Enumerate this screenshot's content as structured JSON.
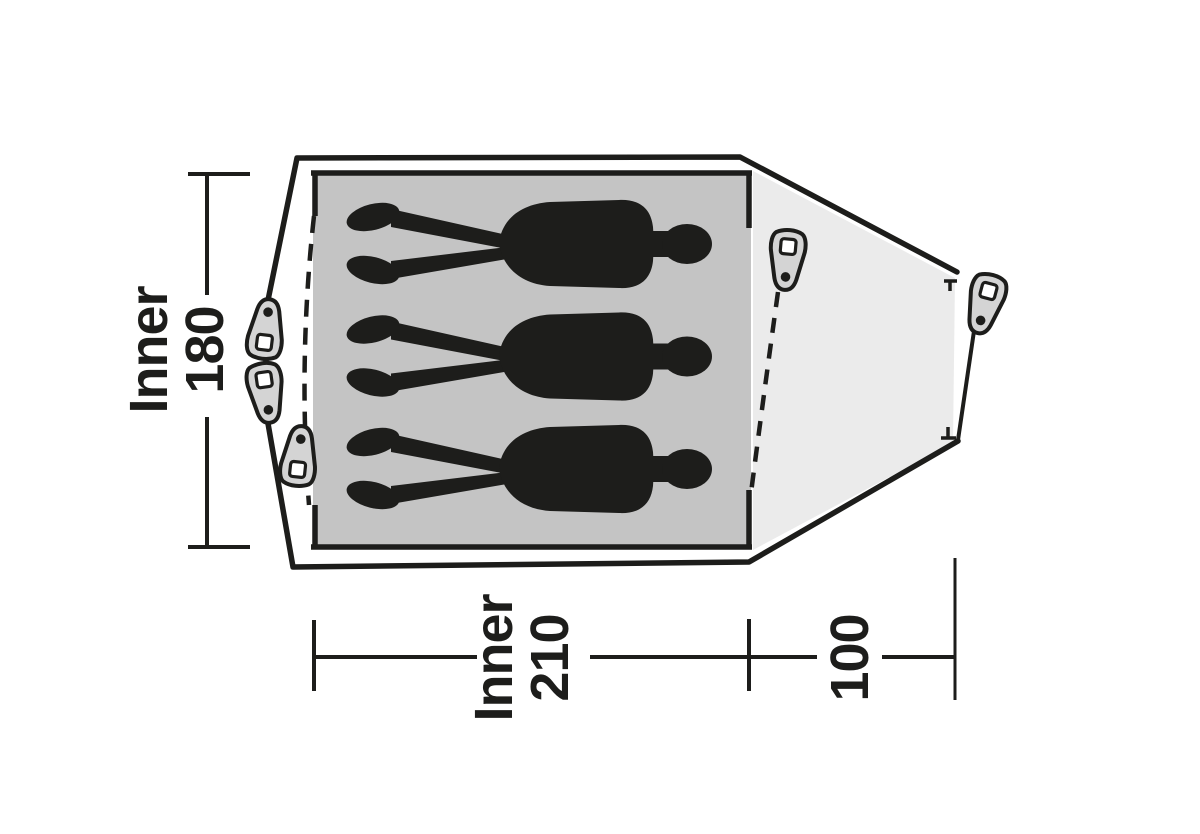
{
  "figure": {
    "type": "tent-floor-plan",
    "occupants": 3,
    "labels": {
      "inner_width": {
        "name": "Inner",
        "value": "180"
      },
      "inner_length": {
        "name": "Inner",
        "value": "210"
      },
      "porch_depth": {
        "value": "100"
      }
    },
    "icons": {
      "peg": "tent-peg-icon",
      "person": "person-silhouette",
      "pole_end": "pole-end-marker"
    },
    "colors": {
      "background": "#ffffff",
      "outline": "#1d1d1b",
      "inner_floor": "#c4c4c4",
      "porch": "#ebebeb",
      "silhouette": "#1d1d1b",
      "peg_fill": "#d4d4d4",
      "peg_hole": "#ffffff",
      "dimension": "#1d1d1b"
    }
  }
}
